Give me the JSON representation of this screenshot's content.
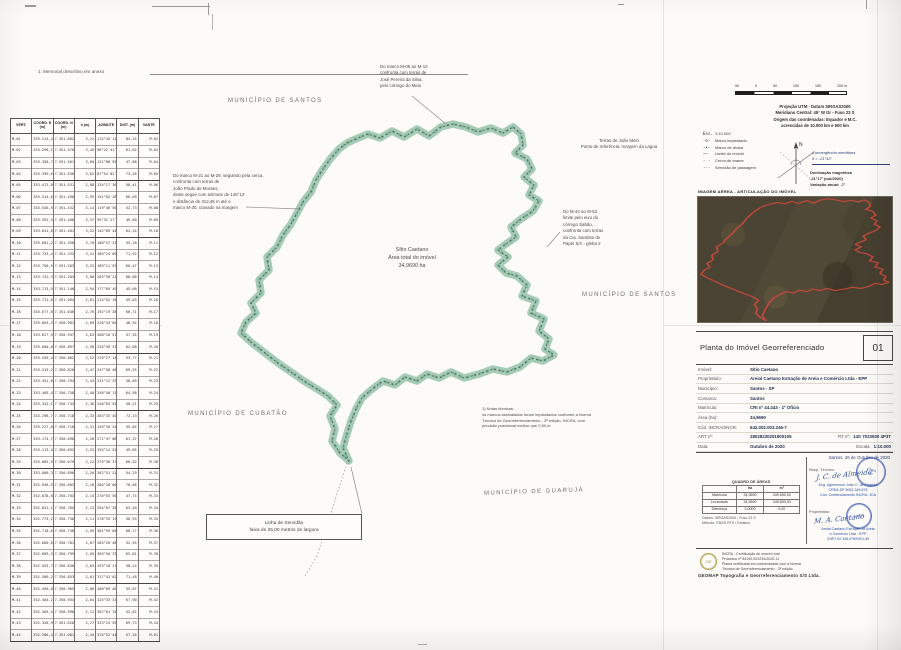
{
  "page": {
    "title_note": "1. Memorial descritivo em anexo"
  },
  "colors": {
    "boundary_green": "#9cc5ae",
    "boundary_dark": "#48584e",
    "inset_outline": "#c2493b",
    "stamp_blue": "#3b5aa0",
    "label_gray": "#6d6d6d"
  },
  "map": {
    "labels": [
      {
        "text": "MUNICÍPIO DE SANTOS"
      },
      {
        "text": "MUNICÍPIO DE SANTOS"
      },
      {
        "text": "MUNICÍPIO DE CUBATÃO"
      },
      {
        "text": "MUNICÍPIO DE GUARUJÁ"
      }
    ],
    "center_label": "Sítio Caetano\nÁrea total do imóvel\n34,9690 ha",
    "servidao_box": "Linha de Servidão\nfaixa de 25,00 metros de largura",
    "ann_top": "Do marco M-08 ao M-12\nconfronta com terras de\nJosé Pereira da Silva,\npelo córrego do Meio",
    "ann_left": "Do marco M-21 ao M-29, seguindo pela cerca,\nconfronta com terras de\nJoão Prado de Moraes,\ndeste segue com azimute de 145°12′\ne distância de 312,45 m até o\nmarco M-30, cravado na margem",
    "ann_right_box": "Terras de João Melo\nPonto de referência: margem da Lagoa",
    "ann_right": "Do M-44 ao M-52\nlimite pelo eixo do\ncórrego Sabão,\nconfronta com terras\nda Cia. Santista de\nPapel S/A - gleba 2",
    "ann_bottom": "1) Notas técnicas:\nos marcos assinalados foram implantados conforme a Norma\nTécnica de Georreferenciamento - 3ª edição, INCRA, com\nprecisão posicional melhor que 0,50 m",
    "polygon": [
      [
        347,
        143
      ],
      [
        358,
        138
      ],
      [
        368,
        134
      ],
      [
        380,
        138
      ],
      [
        392,
        131
      ],
      [
        404,
        137
      ],
      [
        417,
        129
      ],
      [
        429,
        136
      ],
      [
        441,
        127
      ],
      [
        453,
        124
      ],
      [
        466,
        127
      ],
      [
        478,
        132
      ],
      [
        491,
        128
      ],
      [
        503,
        133
      ],
      [
        513,
        127
      ],
      [
        521,
        134
      ],
      [
        523,
        145
      ],
      [
        515,
        153
      ],
      [
        527,
        159
      ],
      [
        532,
        169
      ],
      [
        524,
        177
      ],
      [
        534,
        185
      ],
      [
        529,
        195
      ],
      [
        539,
        201
      ],
      [
        533,
        211
      ],
      [
        521,
        219
      ],
      [
        511,
        227
      ],
      [
        516,
        237
      ],
      [
        506,
        244
      ],
      [
        498,
        250
      ],
      [
        508,
        257
      ],
      [
        498,
        265
      ],
      [
        506,
        273
      ],
      [
        517,
        276
      ],
      [
        527,
        285
      ],
      [
        522,
        296
      ],
      [
        536,
        301
      ],
      [
        531,
        313
      ],
      [
        544,
        319
      ],
      [
        539,
        331
      ],
      [
        549,
        339
      ],
      [
        545,
        349
      ],
      [
        554,
        355
      ],
      [
        543,
        361
      ],
      [
        531,
        358
      ],
      [
        520,
        367
      ],
      [
        507,
        372
      ],
      [
        493,
        369
      ],
      [
        479,
        374
      ],
      [
        464,
        378
      ],
      [
        451,
        372
      ],
      [
        439,
        378
      ],
      [
        427,
        374
      ],
      [
        417,
        381
      ],
      [
        405,
        377
      ],
      [
        395,
        385
      ],
      [
        383,
        381
      ],
      [
        371,
        390
      ],
      [
        362,
        398
      ],
      [
        356,
        409
      ],
      [
        351,
        421
      ],
      [
        347,
        434
      ],
      [
        343,
        448
      ],
      [
        349,
        461
      ],
      [
        340,
        453
      ],
      [
        332,
        441
      ],
      [
        335,
        429
      ],
      [
        330,
        416
      ],
      [
        337,
        405
      ],
      [
        328,
        396
      ],
      [
        317,
        389
      ],
      [
        304,
        381
      ],
      [
        291,
        372
      ],
      [
        278,
        363
      ],
      [
        265,
        353
      ],
      [
        252,
        343
      ],
      [
        241,
        333
      ],
      [
        246,
        322
      ],
      [
        256,
        313
      ],
      [
        251,
        303
      ],
      [
        261,
        293
      ],
      [
        259,
        280
      ],
      [
        269,
        270
      ],
      [
        267,
        257
      ],
      [
        277,
        247
      ],
      [
        283,
        235
      ],
      [
        291,
        224
      ],
      [
        297,
        213
      ],
      [
        303,
        202
      ],
      [
        311,
        192
      ],
      [
        316,
        180
      ],
      [
        323,
        169
      ],
      [
        331,
        158
      ],
      [
        339,
        149
      ]
    ],
    "leaders": [
      [
        412,
        96,
        446,
        124,
        0
      ],
      [
        246,
        207,
        300,
        209,
        0
      ],
      [
        362,
        514,
        351,
        467,
        0
      ],
      [
        347,
        463,
        317,
        556,
        1
      ],
      [
        317,
        556,
        305,
        576,
        1
      ],
      [
        560,
        232,
        547,
        247,
        0
      ]
    ]
  },
  "coordinate_table": {
    "headers": [
      "VÉRT.",
      "COORD. E (m)",
      "COORD. N (m)",
      "h (m)",
      "AZIMUTE",
      "DIST. (m)",
      "VANTE"
    ],
    "rows": [
      [
        "M-01",
        "353.214,45",
        "7.351.602,11",
        "3,21",
        "112°45′12″",
        "84,15",
        "M-02"
      ],
      [
        "M-02",
        "353.298,12",
        "7.351.570,08",
        "3,45",
        "98°22′41″",
        "61,02",
        "M-03"
      ],
      [
        "M-03",
        "353.358,74",
        "7.351.561,30",
        "3,60",
        "121°08′55″",
        "47,88",
        "M-04"
      ],
      [
        "M-04",
        "353.399,61",
        "7.351.536,52",
        "3,02",
        "87°54′02″",
        "73,26",
        "M-05"
      ],
      [
        "M-05",
        "353.472,80",
        "7.351.531,19",
        "2,88",
        "134°17′36″",
        "58,41",
        "M-06"
      ],
      [
        "M-06",
        "353.514,63",
        "7.351.490,27",
        "2,95",
        "151°02′18″",
        "66,09",
        "M-07"
      ],
      [
        "M-07",
        "353.546,57",
        "7.351.432,44",
        "3,14",
        "119°46′50″",
        "52,73",
        "M-08"
      ],
      [
        "M-08",
        "353.592,30",
        "7.351.406,15",
        "3,37",
        "95°31′27″",
        "49,60",
        "M-09"
      ],
      [
        "M-09",
        "353.641,85",
        "7.351.401,86",
        "3,52",
        "142°09′44″",
        "64,34",
        "M-10"
      ],
      [
        "M-10",
        "353.681,22",
        "7.351.350,93",
        "3,70",
        "108°57′31″",
        "55,18",
        "M-11"
      ],
      [
        "M-11",
        "353.733,40",
        "7.351.333,01",
        "3,41",
        "166°24′09″",
        "71,92",
        "M-12"
      ],
      [
        "M-12",
        "353.750,96",
        "7.351.263,28",
        "3,25",
        "189°11′53″",
        "60,47",
        "M-13"
      ],
      [
        "M-13",
        "353.741,37",
        "7.351.203,58",
        "3,08",
        "203°38′22″",
        "68,80",
        "M-14"
      ],
      [
        "M-14",
        "353.713,94",
        "7.351.140,46",
        "2,94",
        "177°05′49″",
        "45,66",
        "M-15"
      ],
      [
        "M-15",
        "353.711,60",
        "7.351.094,86",
        "2,81",
        "214°52′16″",
        "59,03",
        "M-16"
      ],
      [
        "M-16",
        "353.677,81",
        "7.351.046,45",
        "2,76",
        "192°19′38″",
        "66,71",
        "M-17"
      ],
      [
        "M-17",
        "353.663,55",
        "7.350.981,29",
        "2,69",
        "226°43′05″",
        "48,92",
        "M-18"
      ],
      [
        "M-18",
        "353.627,93",
        "7.350.947,78",
        "2,63",
        "208°16′57″",
        "57,35",
        "M-19"
      ],
      [
        "M-19",
        "353.600,84",
        "7.350.897,21",
        "2,58",
        "235°49′33″",
        "62,08",
        "M-20"
      ],
      [
        "M-20",
        "353.549,47",
        "7.350.862,39",
        "2,52",
        "219°27′14″",
        "53,77",
        "M-21"
      ],
      [
        "M-21",
        "353.515,28",
        "7.350.820,90",
        "2,47",
        "247°58′46″",
        "69,25",
        "M-22"
      ],
      [
        "M-22",
        "353.451,06",
        "7.350.794,97",
        "2,43",
        "231°12′29″",
        "58,60",
        "M-23"
      ],
      [
        "M-23",
        "353.405,43",
        "7.350.758,12",
        "2,40",
        "256°40′11″",
        "64,98",
        "M-24"
      ],
      [
        "M-24",
        "353.342,19",
        "7.350.743,67",
        "2,36",
        "240°03′55″",
        "50,21",
        "M-25"
      ],
      [
        "M-25",
        "353.298,70",
        "7.350.718,54",
        "2,33",
        "263°35′40″",
        "72,13",
        "M-26"
      ],
      [
        "M-26",
        "353.227,02",
        "7.350.710,08",
        "2,31",
        "249°20′24″",
        "55,84",
        "M-27"
      ],
      [
        "M-27",
        "353.174,76",
        "7.350.690,39",
        "2,28",
        "271°47′08″",
        "61,37",
        "M-28"
      ],
      [
        "M-28",
        "353.113,41",
        "7.350.692,30",
        "2,25",
        "255°14′52″",
        "49,05",
        "M-29"
      ],
      [
        "M-29",
        "353.065,98",
        "7.350.679,63",
        "2,22",
        "279°36′37″",
        "66,52",
        "M-30"
      ],
      [
        "M-30",
        "353.000,34",
        "7.350.690,75",
        "2,20",
        "262°51′21″",
        "54,29",
        "M-31"
      ],
      [
        "M-31",
        "352.946,53",
        "7.350.683,99",
        "2,18",
        "286°28′06″",
        "70,66",
        "M-32"
      ],
      [
        "M-32",
        "352.878,81",
        "7.350.703,84",
        "2,15",
        "270°55′50″",
        "47,74",
        "M-33"
      ],
      [
        "M-33",
        "352.831,15",
        "7.350.705,01",
        "2,13",
        "294°07′35″",
        "63,40",
        "M-34"
      ],
      [
        "M-34",
        "352.773,28",
        "7.350.730,92",
        "2,11",
        "278°33′19″",
        "56,93",
        "M-35"
      ],
      [
        "M-35",
        "352.718,66",
        "7.350.746,87",
        "2,09",
        "301°59′04″",
        "68,17",
        "M-36"
      ],
      [
        "M-36",
        "352.660,09",
        "7.350.781,76",
        "2,07",
        "285°26′48″",
        "52,55",
        "M-37"
      ],
      [
        "M-37",
        "352.609,37",
        "7.350.795,63",
        "2,05",
        "309°50′33″",
        "65,81",
        "M-38"
      ],
      [
        "M-38",
        "352.553,72",
        "7.350.830,50",
        "2,03",
        "293°18′17″",
        "58,24",
        "M-39"
      ],
      [
        "M-39",
        "352.500,20",
        "7.350.853,46",
        "2,01",
        "317°42′02″",
        "71,48",
        "M-40"
      ],
      [
        "M-40",
        "352.450,88",
        "7.350.905,17",
        "2,00",
        "300°09′46″",
        "55,07",
        "M-41"
      ],
      [
        "M-41",
        "352.404,25",
        "7.350.934,63",
        "2,04",
        "325°33′31″",
        "67,90",
        "M-42"
      ],
      [
        "M-42",
        "352.365,51",
        "7.350.990,29",
        "2,12",
        "307°01′15″",
        "53,62",
        "M-43"
      ],
      [
        "M-43",
        "352.320,94",
        "7.351.020,40",
        "2,27",
        "333°24′59″",
        "69,73",
        "M-44"
      ],
      [
        "M-44",
        "352.286,42",
        "7.351.081,06",
        "2,44",
        "315°52′44″",
        "57,16",
        "M-01"
      ]
    ]
  },
  "legend": {
    "scale_ticks": [
      "50",
      "0",
      "50",
      "100",
      "150",
      "200 m"
    ],
    "datum_block": "Projeção UTM - Datum SIRGAS2000\nMeridiano Central: 45° W Gr - Fuso 23 S\nOrigem das coordenadas: Equador e M.C.\nacrescidas de 10.000 km e 500 km",
    "items": [
      {
        "sym": "Esc.",
        "label": "1:10.000"
      },
      {
        "sym": "-o-",
        "label": "Marco implantado"
      },
      {
        "sym": "-•-",
        "label": "Marco de divisa"
      },
      {
        "sym": "——",
        "label": "Limite do imóvel"
      },
      {
        "sym": "- -",
        "label": "Cerca de arame"
      },
      {
        "sym": "···",
        "label": "Servidão de passagem"
      }
    ],
    "north_label": "N",
    "declination_1": "Convergência meridiana\nδ = -21°43′",
    "declination_2": "Declinação magnética\n-21°17′ (out/2020)\nVariação anual: -7′"
  },
  "inset": {
    "caption": "IMAGEM AÉREA - ARTICULAÇÃO DO IMÓVEL"
  },
  "title_block": {
    "title": "Planta do Imóvel Georreferenciado",
    "sheet_number": "01",
    "fields": [
      {
        "label": "Imóvel:",
        "value": "Sítio Caetano"
      },
      {
        "label": "Proprietário:",
        "value": "Areial Caetano Extração de Areia e Comércio Ltda - EPP"
      },
      {
        "label": "Município:",
        "value": "Santos - SP"
      },
      {
        "label": "Comarca:",
        "value": "Santos"
      },
      {
        "label": "Matrícula:",
        "value": "CRI nº 44.443 - 1º Ofício"
      },
      {
        "label": "Área (ha):",
        "value": "34,9690"
      },
      {
        "label": "Cód. INCRA/SNCR:",
        "value": "642.002.003.246-7"
      },
      {
        "label": "ART nº:",
        "value": "28028230201900105",
        "label2": "RT nº:",
        "value2": "14S 7023930 4P3T"
      },
      {
        "label": "Data:",
        "value": "Outubro de 2020",
        "label2": "Escala:",
        "value2": "1:10.000"
      }
    ],
    "signature_area": {
      "date_line": "Santos, 26 de Outubro de 2020",
      "quadro_title": "QUADRO DE ÁREAS",
      "quadro_headers": [
        "",
        "ha",
        "m²"
      ],
      "quadro_rows": [
        [
          "Matrícula",
          "34,9690",
          "349.690,00"
        ],
        [
          "Levantada",
          "34,9690",
          "349.690,00"
        ],
        [
          "Diferença",
          "0,0000",
          "0,00"
        ]
      ],
      "quadro_notes": "Datum: SIRGAS2000 - Fuso 23 S\nMétodo: GNSS RTK / Estático",
      "sig1_label": "Resp. Técnico:",
      "sig1_name": "J. C. de Almeida",
      "sig1_lines": "Eng. Agrimensor João C. de Almeida\nCREA-SP 5062.345.678\nCód. Credenciamento INCRA: JCA",
      "sig1_stamp": "CREA\nSP",
      "sig2_label": "Proprietário:",
      "sig2_name": "M. A. Caetano",
      "sig2_lines": "Areial Caetano Extração de Areia\ne Comércio Ltda - EPP\nCNPJ 02.345.678/0001-55",
      "sig2_stamp": "INCRA"
    },
    "footer": {
      "seal": "CAT",
      "lines": "INCRA - Certificação de imóvel rural\nProcesso nº 54190.001234/2020-11\nPlanta certificada em conformidade com a Norma\nTécnica de Georreferenciamento - 3ª edição",
      "bold_line": "GEOMAP Topografia e Georreferenciamento S/S Ltda."
    }
  }
}
